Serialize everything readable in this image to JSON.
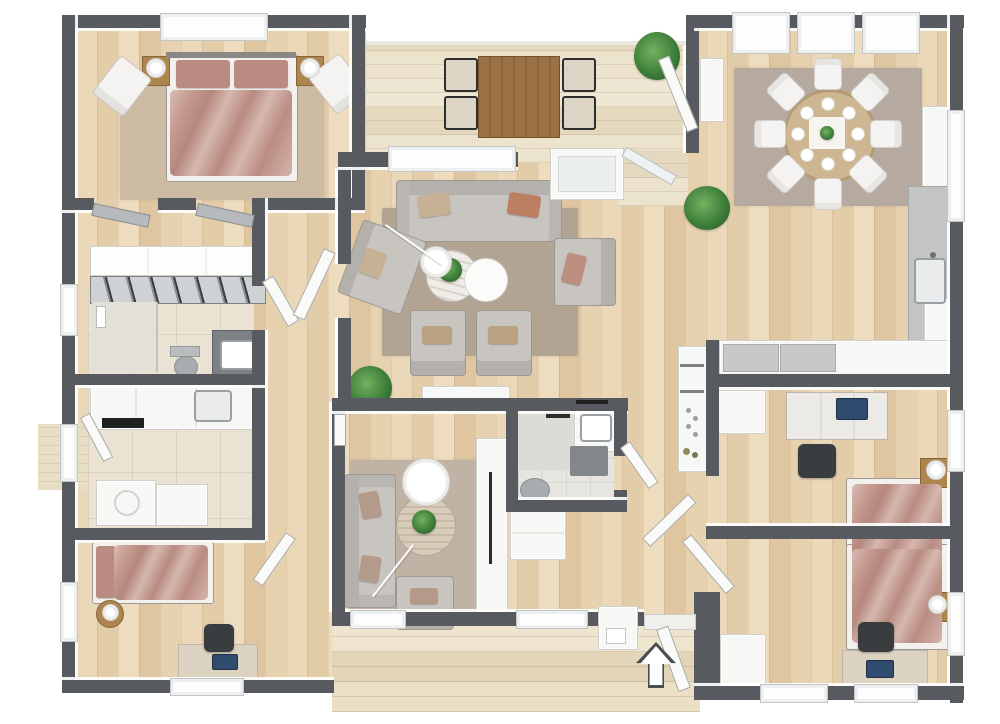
{
  "scene": {
    "kind": "3d-floor-plan-render",
    "view": "top-down",
    "entry_arrow_direction": "up"
  },
  "colors": {
    "wall": "#575a5e",
    "wood_furn": "#ad854f",
    "sofa": "#c8c4c0",
    "bed": "#c4988d",
    "bed_pillow": "#ba8b82",
    "office_chair": "#3a3d40",
    "laptop": "#2f4c6e",
    "arrow_outline": "#4a4d50",
    "rug_master": "#cdbaa3",
    "rug_living": "#b2a492",
    "rug_dining": "#b5a9a0",
    "rug_den": "#c0b3a5",
    "plant_green": "#3e7f3a",
    "counter_concrete": "#c3c5c5",
    "outdoor_table_wood": "#9b7245",
    "dining_table_wood": "#cdb691"
  },
  "rooms": [
    {
      "name": "master-bedroom",
      "furniture": [
        "double-bed",
        "nightstand-left",
        "nightstand-right",
        "table-lamps",
        "accent-chair-left",
        "accent-chair-right",
        "area-rug",
        "window"
      ]
    },
    {
      "name": "hallway-closets",
      "furniture": [
        "wardrobe",
        "sliding-door-closet",
        "closet-door-left",
        "closet-door-right"
      ]
    },
    {
      "name": "bathroom-1",
      "furniture": [
        "shower",
        "toilet",
        "vanity-sink",
        "window"
      ]
    },
    {
      "name": "kitchenette",
      "furniture": [
        "counter-run",
        "cooktop",
        "sink",
        "side-door"
      ]
    },
    {
      "name": "utility-room",
      "furniture": [
        "washer",
        "cabinet"
      ]
    },
    {
      "name": "bedroom-2",
      "furniture": [
        "single-bed",
        "round-nightstand",
        "table-lamp",
        "desk",
        "office-chair",
        "laptop",
        "windows"
      ]
    },
    {
      "name": "living-room",
      "furniture": [
        "three-seat-sofa",
        "loveseat",
        "armchair-right",
        "armchair-bottom-left",
        "armchair-bottom-right",
        "marble-coffee-table",
        "white-coffee-table",
        "arc-floor-lamp",
        "sideboard",
        "potted-plant",
        "area-rug",
        "window"
      ]
    },
    {
      "name": "tv-den",
      "furniture": [
        "sofa",
        "armchair",
        "round-coffee-table",
        "floor-lamp",
        "tall-tv-cabinet",
        "area-rug"
      ]
    },
    {
      "name": "bathroom-2",
      "furniture": [
        "walk-in-shower",
        "vanity-sink",
        "toilet",
        "bath-mat",
        "dresser-below"
      ]
    },
    {
      "name": "terrace",
      "furniture": [
        "outdoor-dining-table",
        "outdoor-chairs-x4",
        "potted-plant",
        "glass-door-to-dining",
        "landing-box-to-living"
      ]
    },
    {
      "name": "dining-room",
      "furniture": [
        "round-dining-table",
        "dining-chairs-x8",
        "place-settings-x8",
        "centerpiece-plant",
        "area-rug",
        "floor-plant",
        "windows-x3",
        "tall-white-cabinet"
      ]
    },
    {
      "name": "kitchen",
      "furniture": [
        "tall-cabinet",
        "l-counter-concrete",
        "sink",
        "base-cabinet",
        "appliance-column-with-knobs"
      ]
    },
    {
      "name": "hallway",
      "furniture": [
        "closet-bank",
        "floor-plant"
      ]
    },
    {
      "name": "bedroom-3",
      "furniture": [
        "single-bed",
        "nightstand",
        "table-lamp",
        "desk",
        "office-chair",
        "laptop",
        "dresser",
        "window"
      ]
    },
    {
      "name": "bedroom-4",
      "furniture": [
        "single-bed",
        "nightstand",
        "table-lamp",
        "desk",
        "office-chair",
        "laptop",
        "dresser",
        "windows"
      ]
    },
    {
      "name": "entry-porch",
      "furniture": [
        "open-front-door",
        "entry-arrow",
        "porch-bench",
        "deck-boards"
      ]
    },
    {
      "name": "side-deck",
      "furniture": [
        "deck-steps",
        "side-door"
      ]
    }
  ]
}
